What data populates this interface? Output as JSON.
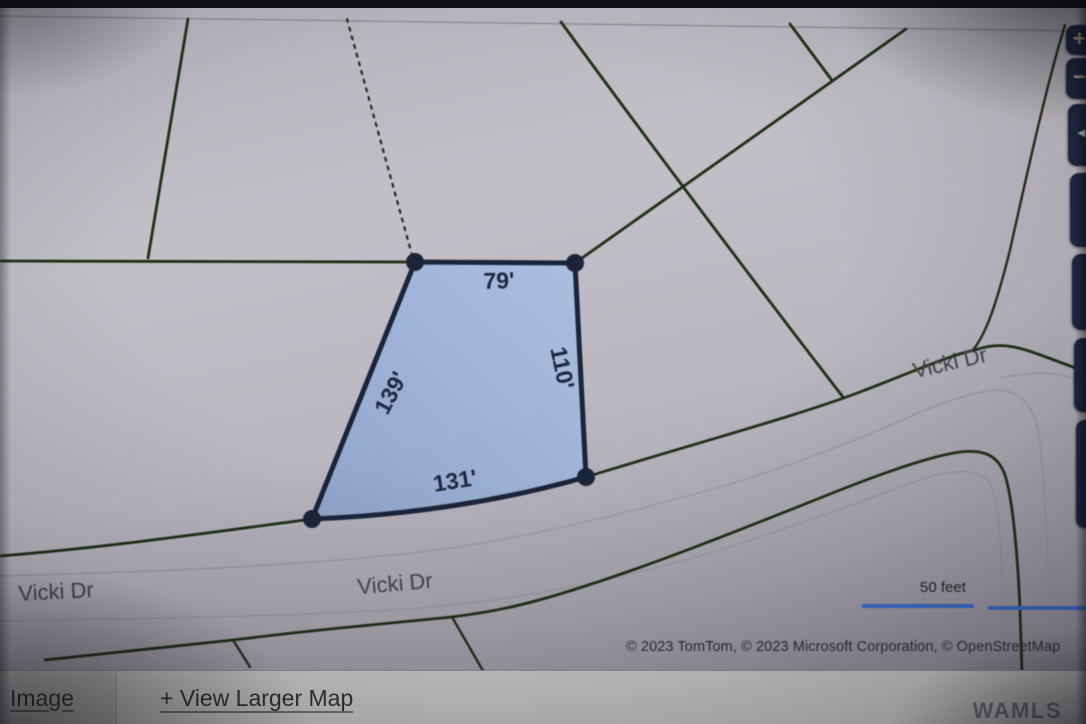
{
  "map": {
    "parcel": {
      "labels": {
        "top": "79'",
        "right": "110'",
        "bottom": "131'",
        "left": "139'"
      },
      "fill_color": "#9db3d8",
      "border_color": "#1b2439"
    },
    "roads": {
      "label_bottom_left": "Vicki Dr",
      "label_bottom_center": "Vicki Dr",
      "label_upper_right": "Vicki Dr"
    },
    "scale_label": "50 feet",
    "scale_bar_color": "#3a6fd0",
    "boundary_line_color": "#1e3014",
    "attribution": "© 2023 TomTom, © 2023 Microsoft Corporation, © OpenStreetMap",
    "controls": {
      "zoom_in": "+",
      "zoom_out": "−",
      "pan": "◄"
    }
  },
  "footer": {
    "image_tab": "Image",
    "view_larger_link": "+ View Larger Map",
    "watermark": "WAMLS"
  }
}
